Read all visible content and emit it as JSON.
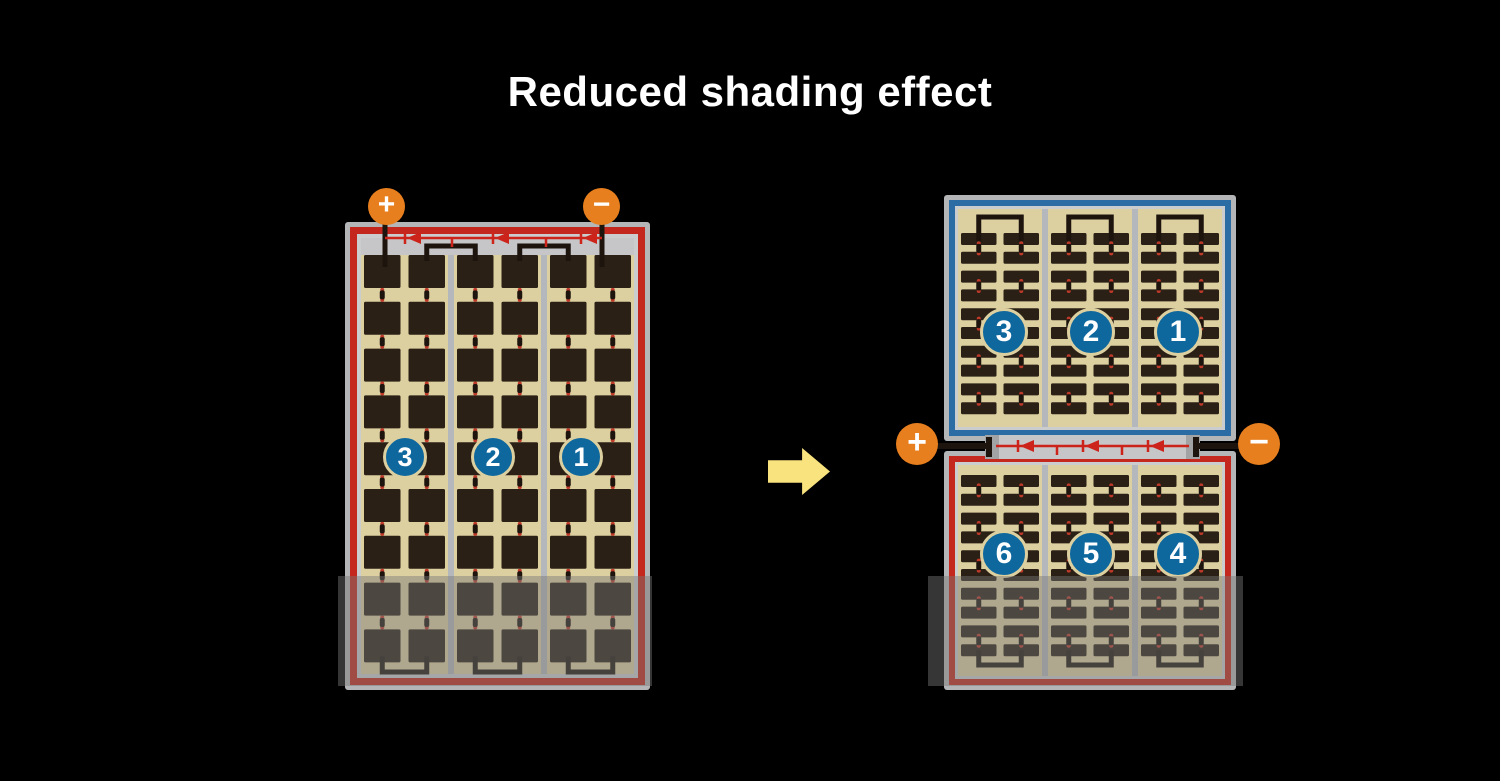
{
  "title": "Reduced shading effect",
  "colors": {
    "background": "#000000",
    "title_text": "#ffffff",
    "terminal_orange": "#e87f1e",
    "terminal_symbol": "#ffffff",
    "frame_gray": "#b4b5b7",
    "frame_light": "#cbccce",
    "strip_gray": "#c6c6c8",
    "border_red": "#c3271d",
    "border_blue": "#2b6ca4",
    "cell_tan": "#ddd0a0",
    "cell_dark": "#2a2016",
    "divider_gray": "#b4b7bb",
    "bus_black": "#1d140e",
    "diode_red": "#cc231b",
    "connector_red": "#c03a2a",
    "circle_blue": "#0e689d",
    "circle_ring": "#ddd0a0",
    "arrow_yellow": "#f9e37e",
    "shade_overlay": "rgba(120,120,120,0.45)"
  },
  "left_panel": {
    "positive_symbol": "+",
    "negative_symbol": "−",
    "section_labels": [
      "3",
      "2",
      "1"
    ]
  },
  "right_panel": {
    "positive_symbol": "+",
    "negative_symbol": "−",
    "top_section_labels": [
      "3",
      "2",
      "1"
    ],
    "bottom_section_labels": [
      "6",
      "5",
      "4"
    ]
  }
}
